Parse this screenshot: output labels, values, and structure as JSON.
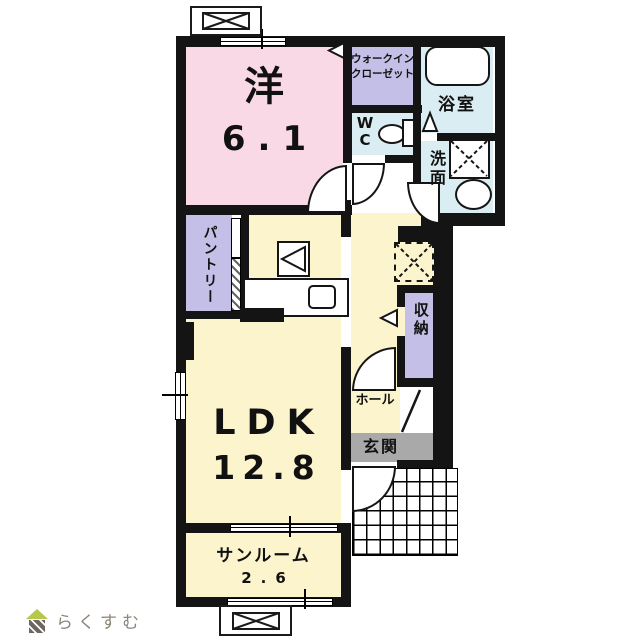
{
  "rooms": {
    "bedroom": {
      "label": "洋",
      "size": "6.1"
    },
    "wic": {
      "line1": "ウォークイン",
      "line2": "クローゼット"
    },
    "bath": {
      "label": "浴室"
    },
    "wc": {
      "line1": "W",
      "line2": "C"
    },
    "washroom": {
      "label": "洗面"
    },
    "pantry": {
      "label": "パントリー"
    },
    "ldk": {
      "label": "LDK",
      "size": "12.8"
    },
    "storage": {
      "label": "収納"
    },
    "hall": {
      "label": "ホール"
    },
    "entrance": {
      "label": "玄関"
    },
    "sunroom": {
      "label": "サンルーム",
      "size": "2.6"
    }
  },
  "logo": {
    "text": "らくすむ"
  },
  "colors": {
    "wall": "#141414",
    "bedroom_pink": "#fad9e6",
    "closet_purple": "#c3bfe6",
    "water_blue": "#d9edf3",
    "living_yellow": "#fbf4cd",
    "entrance_gray": "#a9a9a9",
    "logo_roof_green": "#b9c64c",
    "logo_body_brown": "#6e675f",
    "logo_text_gray": "#8d8478"
  }
}
